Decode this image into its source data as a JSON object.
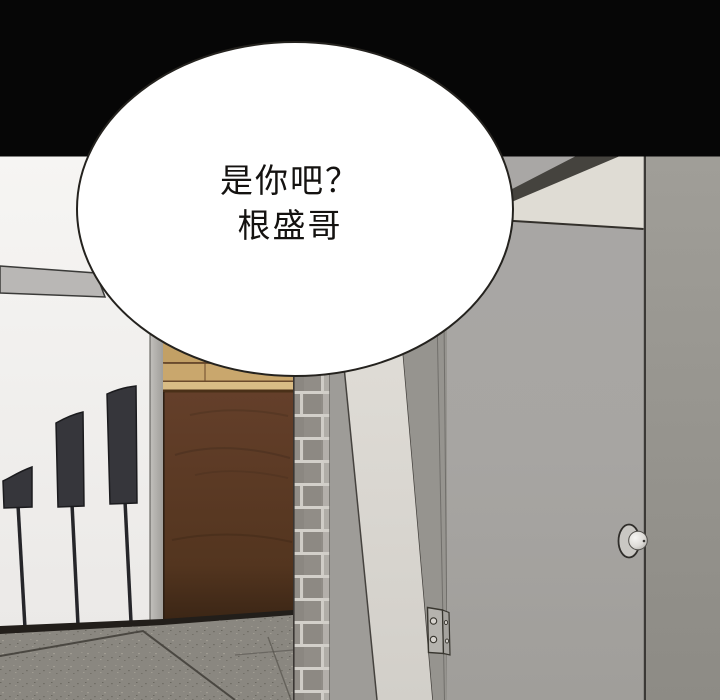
{
  "panel": {
    "type": "webtoon-comic-panel",
    "speech_bubble": {
      "lines": [
        "是你吧？",
        "根盛哥"
      ]
    },
    "palette": {
      "background_black": "#060606",
      "bubble_fill": "#ffffff",
      "bubble_outline": "#24221e",
      "text_color": "#141210",
      "left_wall_top": "#f6f5f3",
      "left_wall_bottom": "#ebe9e7",
      "wall_rail": "#b9b7b5",
      "flag": "#36363b",
      "flag_pole": "#26262a",
      "corner_trim": "#b4b2ae",
      "wood_plank_light": "#c9a76d",
      "wood_plank_highlight": "#d9bc85",
      "wood_door_dark": "#573826",
      "baseboard": "#221e1a",
      "floor": "#8a8780",
      "floor_seam": "#4a4741",
      "brick": "#918d87",
      "brick_mortar": "#d3d0ca",
      "door_frame_shadow": "#96948f",
      "door_jamb_light": "#dcd9d3",
      "gray_door": "#a8a6a4",
      "door_top_band": "#45433e",
      "door_header_beige": "#dfdcd4",
      "door_edge_line": "#3b3936",
      "right_wall": "#9c9a94",
      "doorknob": "#e9e7e3",
      "hinge": "#b5b3ae"
    }
  }
}
